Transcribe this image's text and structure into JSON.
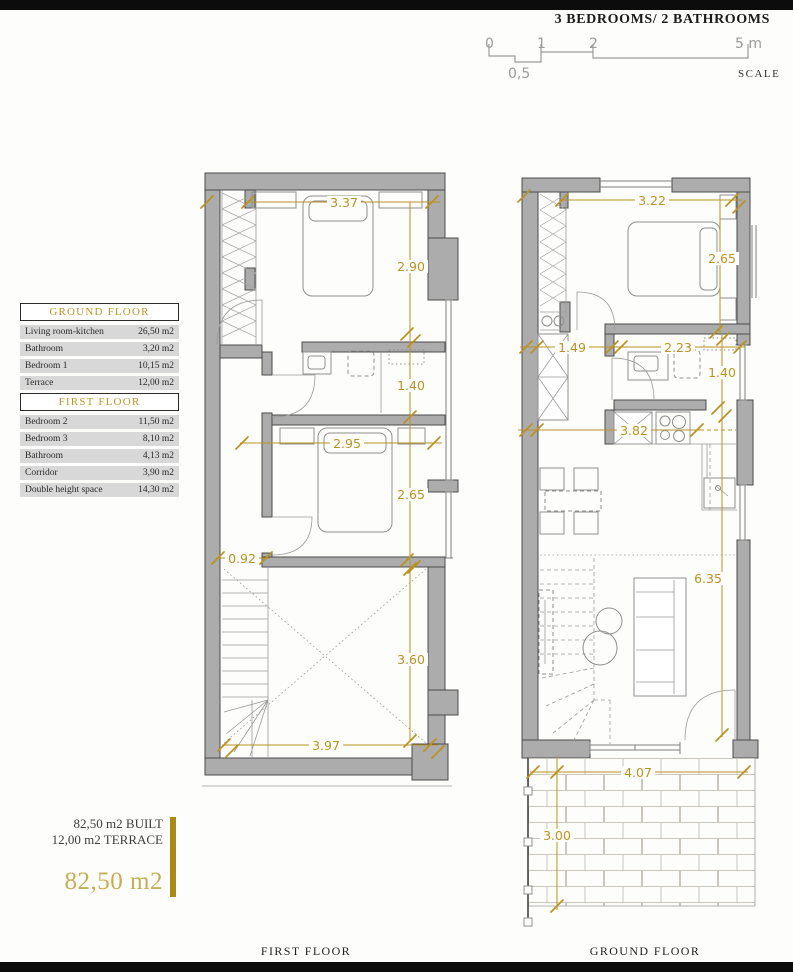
{
  "header": {
    "title": "3 BEDROOMS/ 2 BATHROOMS"
  },
  "scale": {
    "t0": "0",
    "t1": "1",
    "t2": "2",
    "t5": "5 m",
    "half": "0,5",
    "caption": "SCALE"
  },
  "legend": {
    "ground_header": "GROUND FLOOR",
    "ground_rows": [
      [
        "Living room-kitchen",
        "26,50 m2"
      ],
      [
        "Bathroom",
        "3,20 m2"
      ],
      [
        "Bedroom 1",
        "10,15 m2"
      ],
      [
        "Terrace",
        "12,00 m2"
      ]
    ],
    "first_header": "FIRST FLOOR",
    "first_rows": [
      [
        "Bedroom 2",
        "11,50 m2"
      ],
      [
        "Bedroom 3",
        "8,10 m2"
      ],
      [
        "Bathroom",
        "4,13 m2"
      ],
      [
        "Corridor",
        "3,90 m2"
      ],
      [
        "Double height space",
        "14,30 m2"
      ]
    ]
  },
  "summary": {
    "built": "82,50 m2 BUILT",
    "terrace": "12,00 m2 TERRACE",
    "total": "82,50 m2"
  },
  "first_floor": {
    "caption": "FIRST FLOOR",
    "dims": {
      "width_top": "3.37",
      "bedroom2_h": "2.90",
      "bath_h": "1.40",
      "bedroom3_w": "2.95",
      "bedroom3_h": "2.65",
      "corridor_w": "0.92",
      "void_h": "3.60",
      "width_bottom": "3.97"
    }
  },
  "ground_floor": {
    "caption": "GROUND FLOOR",
    "dims": {
      "width_top": "3.22",
      "bedroom1_h": "2.65",
      "hall_w": "1.49",
      "bath_w": "2.23",
      "bath_h": "1.40",
      "kitchen_w": "3.82",
      "living_h": "6.35",
      "terrace_w": "4.07",
      "terrace_h": "3.00"
    }
  },
  "colors": {
    "accent_gold": "#bb9221",
    "total_gold": "#c6ae55",
    "wall_gray": "#acacac",
    "row_gray": "#d8d8d8",
    "bar_black": "#0c0c0c"
  }
}
